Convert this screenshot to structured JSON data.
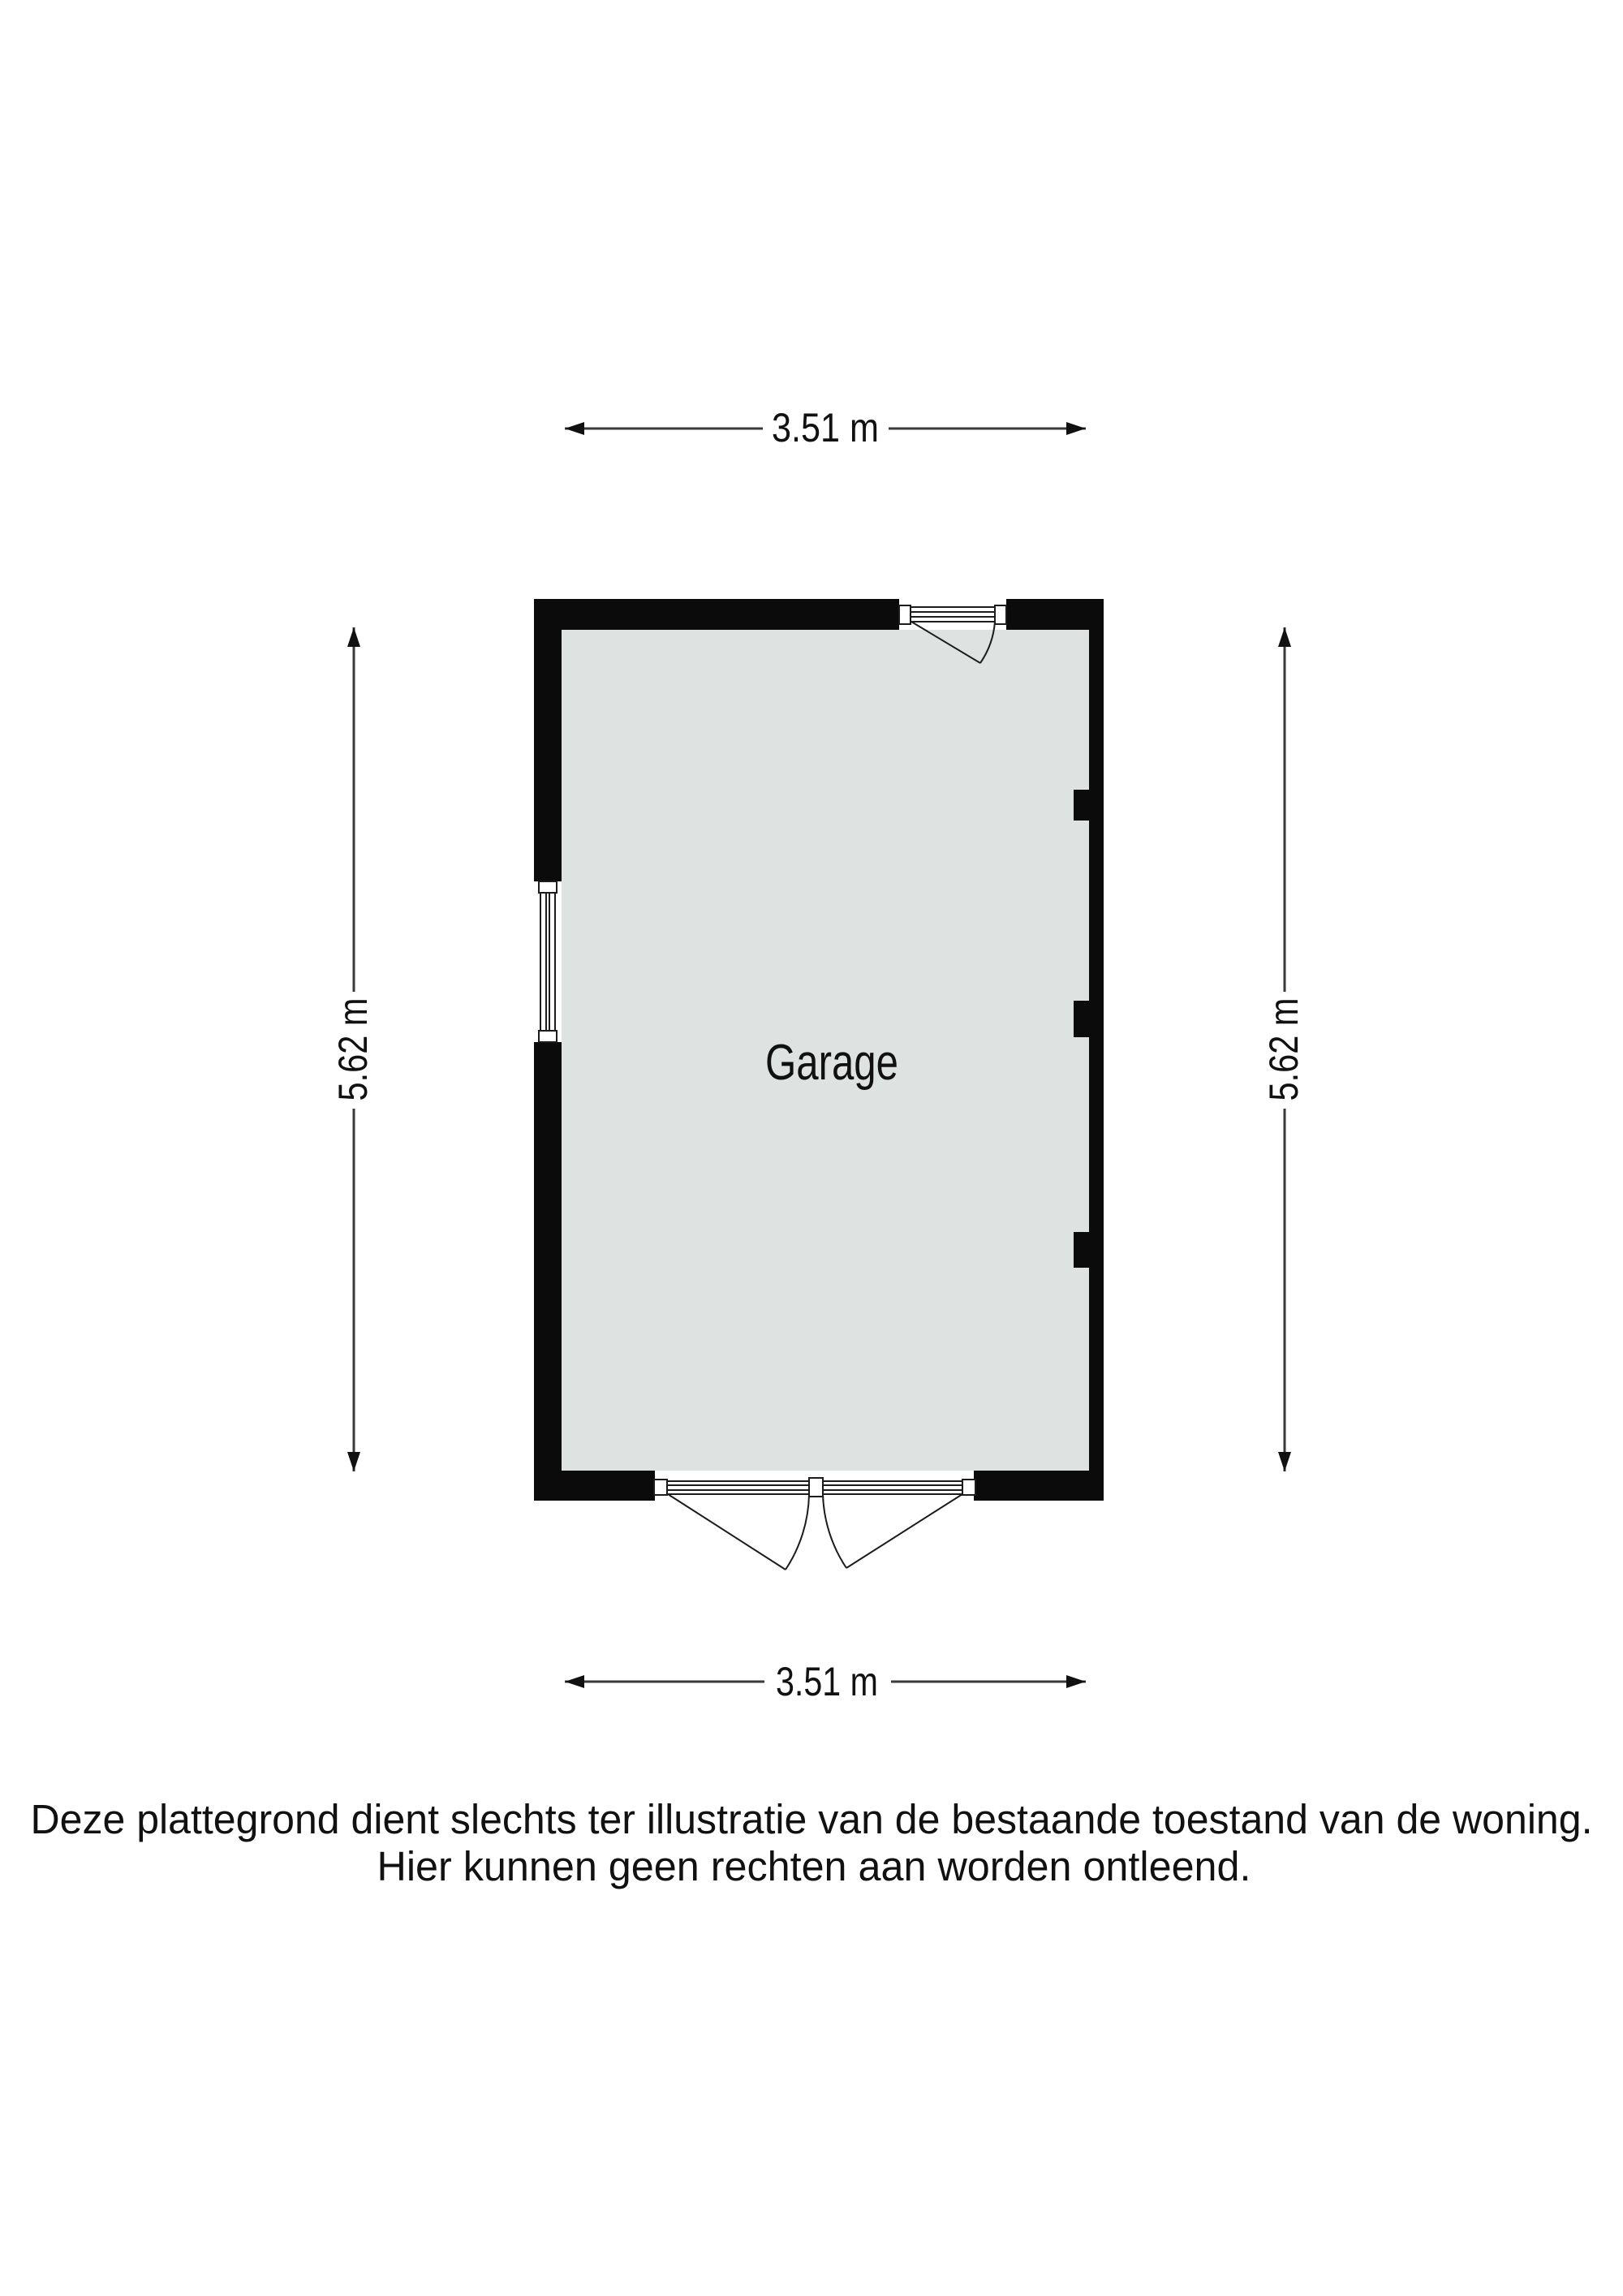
{
  "page": {
    "background": "#ffffff"
  },
  "floorplan": {
    "room": {
      "label": "Garage"
    },
    "dimensions": {
      "top": "3.51 m",
      "bottom": "3.51 m",
      "left": "5.62 m",
      "right": "5.62 m"
    },
    "disclaimer": {
      "line1": "Deze plattegrond dient slechts ter illustratie van de bestaande toestand van de woning.",
      "line2": "Hier kunnen geen rechten aan worden ontleend."
    },
    "colors": {
      "floor_fill": "#dee3e2",
      "wall_fill": "#0b0b0b",
      "fixture_stroke": "#1c1c1c",
      "dimension_line": "#3a3a3a",
      "arrowhead": "#111111",
      "label_text": "#111111"
    }
  }
}
